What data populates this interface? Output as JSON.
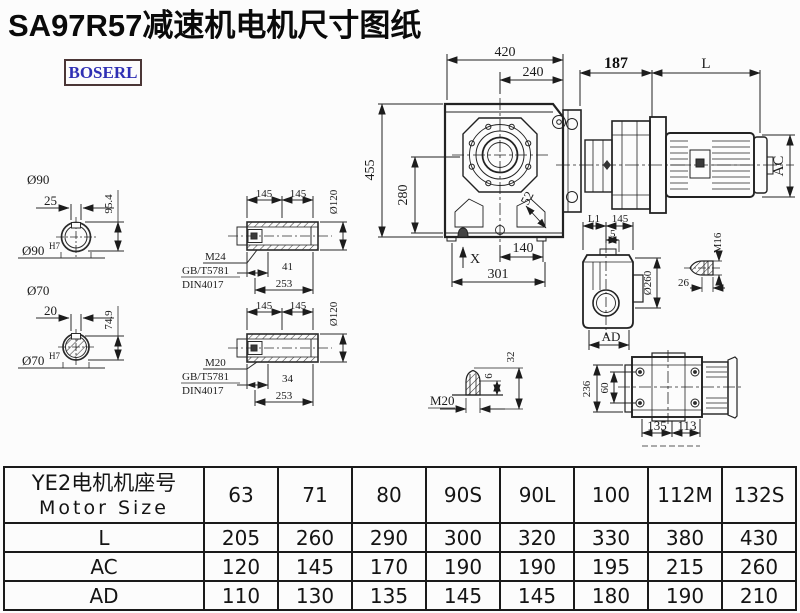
{
  "title": "SA97R57减速机电机尺寸图纸",
  "logo": "BOSERL",
  "views": {
    "bore90": {
      "label": "Ø90",
      "key_width": "25",
      "height": "95.4",
      "fit": "Ø90",
      "fit_sup": "H7"
    },
    "bore70": {
      "label": "Ø70",
      "key_width": "20",
      "height": "74.9",
      "fit": "Ø70",
      "fit_sup": "H7"
    },
    "hollow_shaft_top": {
      "len_a": "145",
      "len_b": "145",
      "dia": "Ø120",
      "thread": "M24",
      "std1": "GB/T5781",
      "std2": "DIN4017",
      "depth": "41",
      "length": "253"
    },
    "hollow_shaft_bottom": {
      "len_a": "145",
      "len_b": "145",
      "dia": "Ø120",
      "thread": "M20",
      "std1": "GB/T5781",
      "std2": "DIN4017",
      "depth": "34",
      "length": "253"
    },
    "front_view": {
      "width": "420",
      "half_width": "240",
      "height": "455",
      "center_height": "280",
      "offset": "52",
      "foot": "140",
      "base": "301",
      "x_mark": "X"
    },
    "motor_view": {
      "adapter": "187",
      "motor_len": "L",
      "motor_dia": "AC"
    },
    "side_view": {
      "l1": "L1",
      "d145": "145",
      "d5": "5",
      "dia": "Ø260",
      "ad": "AD",
      "bolt": "M16",
      "bolt_len": "26"
    },
    "plug_view": {
      "thread": "M20",
      "d6": "6",
      "d32": "32"
    },
    "top_view": {
      "d236": "236",
      "d60": "60",
      "d135": "135",
      "d113": "113"
    }
  },
  "table": {
    "header_cn": "YE2电机机座号",
    "header_en": "Motor Size",
    "sizes": [
      "63",
      "71",
      "80",
      "90S",
      "90L",
      "100",
      "112M",
      "132S"
    ],
    "rows": [
      {
        "label": "L",
        "values": [
          "205",
          "260",
          "290",
          "300",
          "320",
          "330",
          "380",
          "430"
        ]
      },
      {
        "label": "AC",
        "values": [
          "120",
          "145",
          "170",
          "190",
          "190",
          "195",
          "215",
          "260"
        ]
      },
      {
        "label": "AD",
        "values": [
          "110",
          "130",
          "135",
          "145",
          "145",
          "180",
          "190",
          "210"
        ]
      }
    ]
  }
}
